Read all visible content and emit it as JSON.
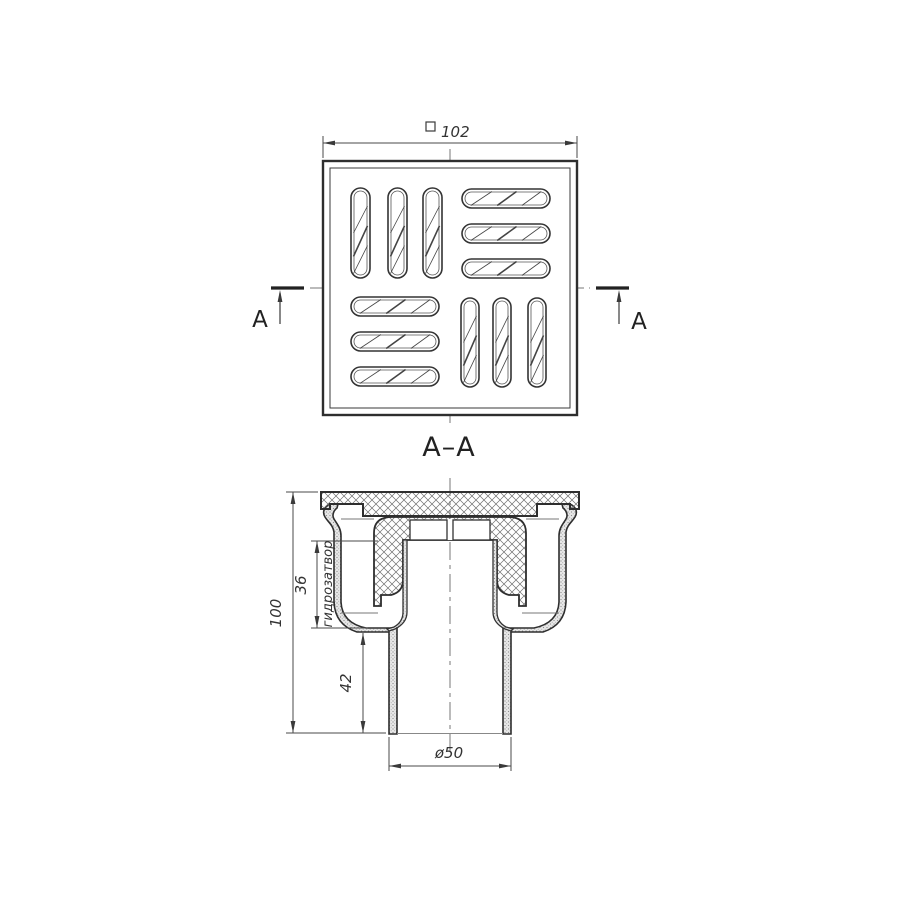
{
  "page": {
    "background": "#ffffff"
  },
  "top_view": {
    "outer_size_dim": {
      "symbol": "square",
      "value": "102"
    },
    "cut_label_left": "A",
    "cut_label_right": "A"
  },
  "section_view": {
    "title": "A–A",
    "dim_total_height": "100",
    "dim_water_seal_height": "36",
    "water_seal_label": "гидрозатвор",
    "dim_outlet_length": "42",
    "dim_outlet_diameter": "ø50"
  },
  "colors": {
    "main_line": "#2e2e2e",
    "thin_line": "#555555",
    "dim_line": "#4a4a4a",
    "hatch": "#6f6f6f",
    "centerline": "#777777",
    "text": "#2a2a2a"
  }
}
